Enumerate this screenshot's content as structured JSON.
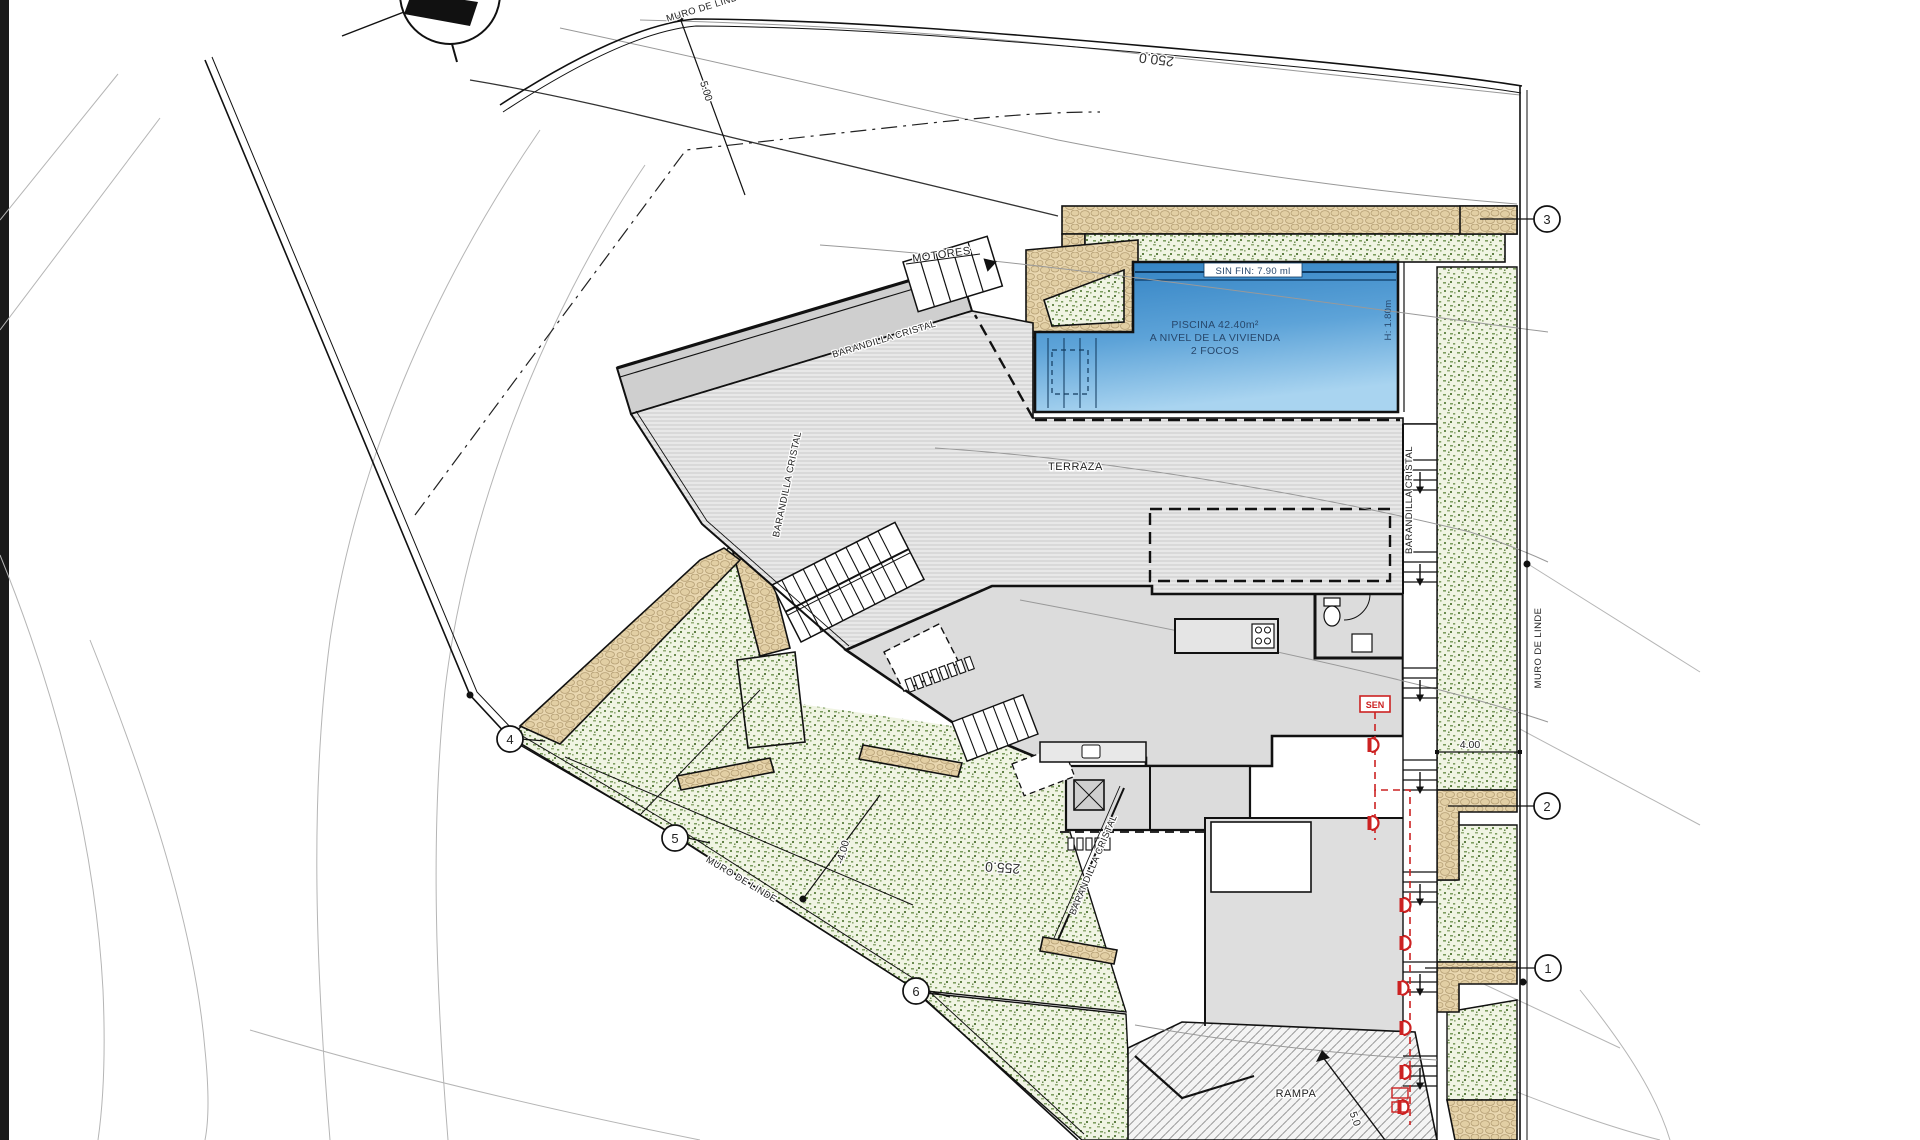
{
  "labels": {
    "motores": "MOTORES",
    "terraza": "TERRAZA",
    "rampa": "RAMPA",
    "sen": "SEN",
    "barandilla_cristal": "BARANDILLA CRISTAL",
    "muro_de_linde": "MURO DE LINDE",
    "sin_fin": "SIN FIN: 7.90 ml",
    "piscina_line1": "PISCINA 42.40m²",
    "piscina_line2": "A NIVEL DE LA VIVIENDA",
    "piscina_line3": "2 FOCOS",
    "pool_depth": "H: 1.80m"
  },
  "contours": {
    "c250": "250.0",
    "c255": "255.0"
  },
  "dimensions": {
    "top": "5.00",
    "right": "4.00",
    "slope": "-4.00",
    "bottom": "5.0"
  },
  "markers": {
    "m1": "1",
    "m2": "2",
    "m3": "3",
    "m4": "4",
    "m5": "5",
    "m6": "6"
  },
  "colors": {
    "pool_water_top": "#2f80c2",
    "pool_water_bottom": "#a9d4f0",
    "vegetation_speck": "#7d9e60",
    "stone_wall": "#e9d7b0",
    "building_gray": "#dcdcdc",
    "line_black": "#111111",
    "accent_red": "#cc2222"
  }
}
